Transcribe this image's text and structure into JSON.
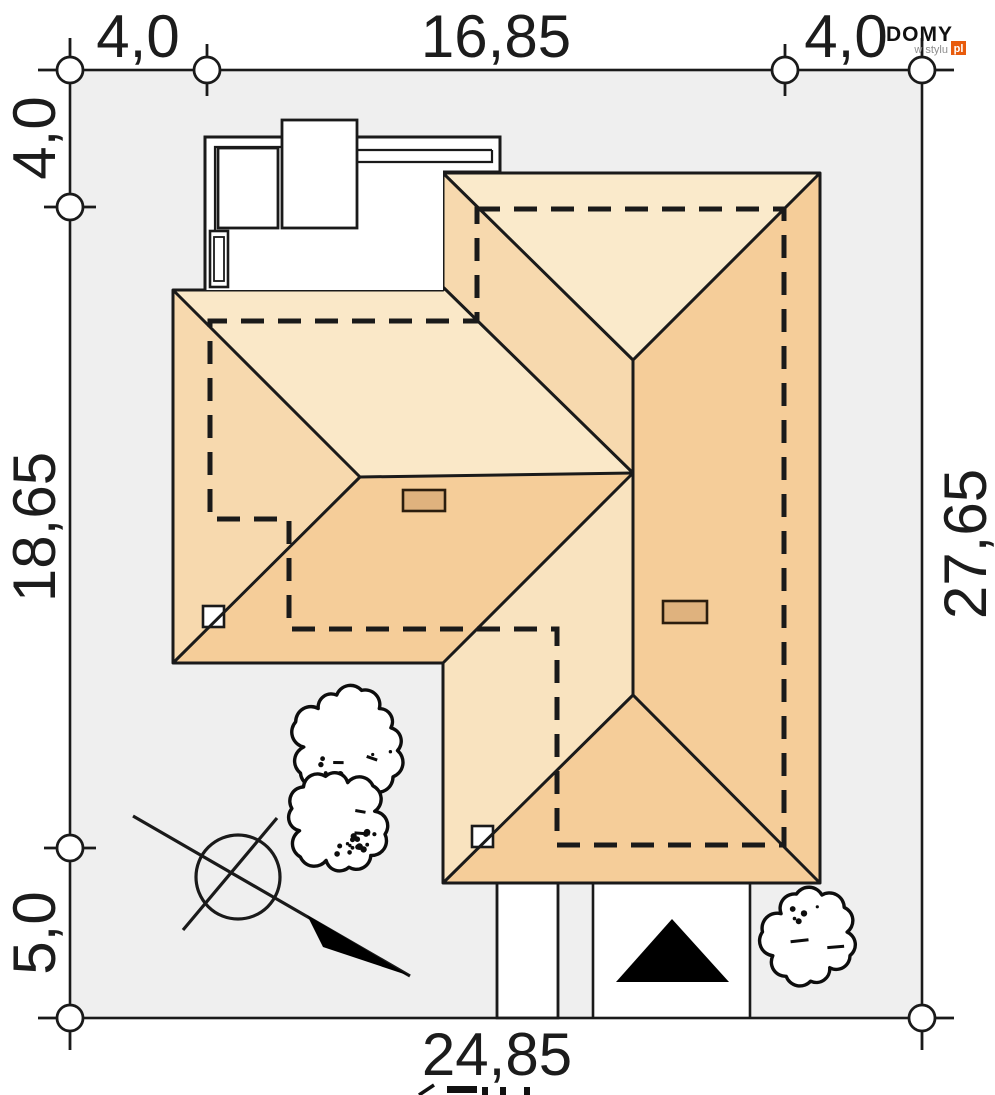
{
  "drawing": {
    "type": "house site plan (roof plan view)",
    "dimensions": {
      "top_left": "4,0",
      "top_center": "16,85",
      "top_right": "4,0",
      "left_top": "4,0",
      "left_middle": "18,65",
      "left_bottom": "5,0",
      "right_side": "27,65",
      "bottom": "24,85"
    },
    "symbols": {
      "north_indicator": "compass circle with arrow line",
      "entrance_arrow": "black triangle pointing to house entrance",
      "trees": "two deciduous trees (plan symbols)",
      "shrub": "one shrub near driveway",
      "chimneys": "two roof chimney rectangles",
      "building_wall_outline": "dashed line under roof overhang"
    }
  },
  "logo": {
    "brand": "DOMY",
    "tagline": "w stylu",
    "tld": "pl"
  },
  "colors": {
    "plot_fill": "#efefef",
    "line": "#1a1a1a",
    "roof_light": "#faeacb",
    "roof_cream": "#fae8c8",
    "roof_medium": "#f7d9ae",
    "roof_pale": "#f9e3bf",
    "roof_dark": "#f5cd99",
    "chimney": "#dfb27e",
    "white": "#ffffff",
    "logo_orange": "#e85b0c",
    "text": "#1c1c1c"
  }
}
